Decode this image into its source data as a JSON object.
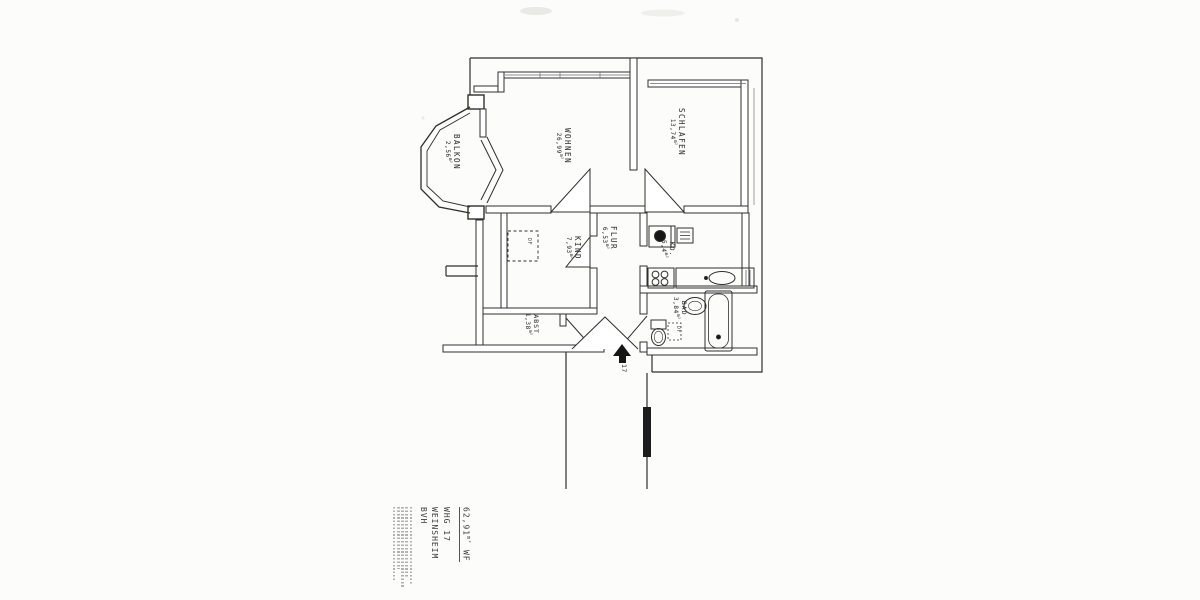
{
  "rooms": [
    {
      "name": "WOHNEN",
      "area": "26,99"
    },
    {
      "name": "SCHLAFEN",
      "area": "13,74"
    },
    {
      "name": "BALKON",
      "area": "2,56"
    },
    {
      "name": "KIND",
      "area": "7,93"
    },
    {
      "name": "FLUR",
      "area": "6,53"
    },
    {
      "name": "KO.",
      "area": "5,4"
    },
    {
      "name": "BAD",
      "area": "3,84"
    },
    {
      "name": "ABST",
      "area": "1,38"
    }
  ],
  "annotations": {
    "area_unit": "m²",
    "roof_window_label": "DF",
    "entrance_unit_number": "17"
  },
  "title_block": {
    "total_area": "62,91",
    "total_area_unit": "m²",
    "total_area_suffix": " WF",
    "line_whg": "WHG 17",
    "line_city": "WEINSHEIM",
    "line_bvh": "BVH"
  },
  "colors": {
    "paper": "#fcfcfb",
    "ink": "#2f2f2f"
  }
}
